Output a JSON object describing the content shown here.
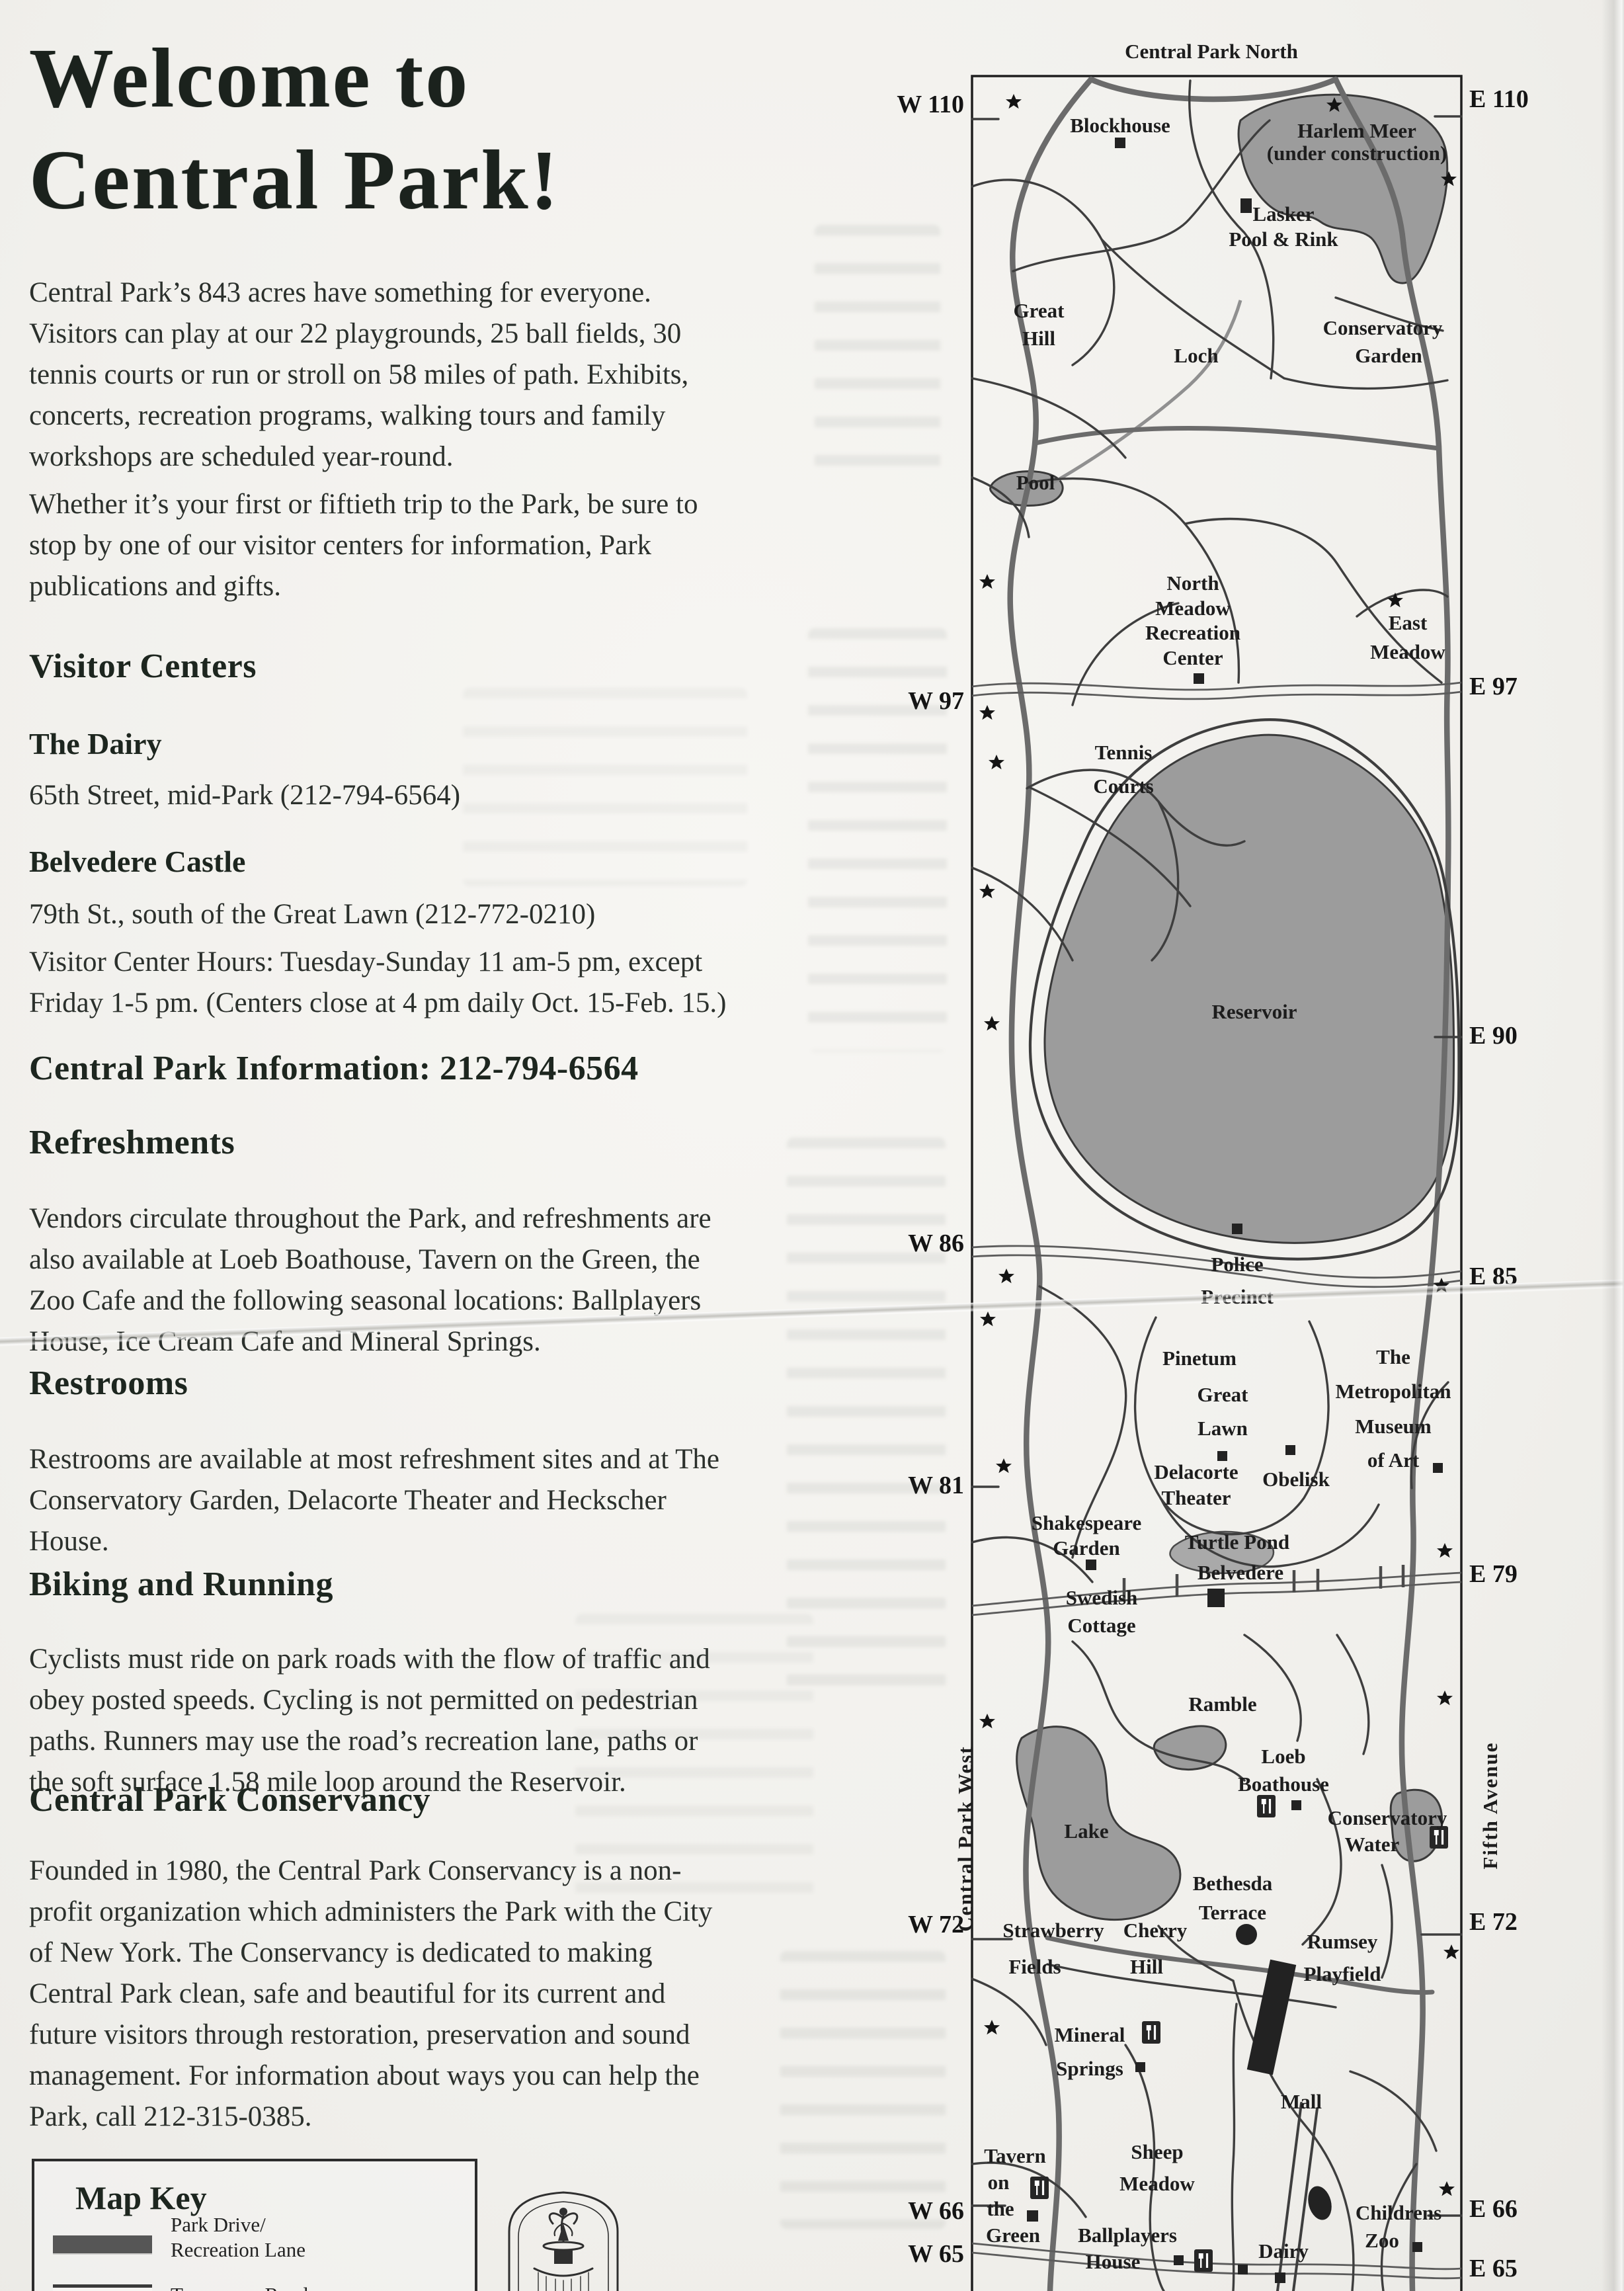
{
  "doc": {
    "title1": "Welcome to",
    "title2": "Central Park!",
    "p1": [
      "Central Park’s 843 acres have something for everyone.",
      "Visitors can play at our 22 playgrounds, 25 ball fields, 30",
      "tennis courts or run or stroll on 58 miles of path. Exhibits,",
      "concerts, recreation programs, walking tours and family",
      "workshops are scheduled year-round."
    ],
    "p2": [
      "Whether it’s your first or fiftieth trip to the Park, be sure to",
      "stop by one of our visitor centers for information, Park",
      "publications and gifts."
    ],
    "vc_heading": "Visitor Centers",
    "dairy_name": "The Dairy",
    "dairy_detail": "65th Street, mid-Park (212-794-6564)",
    "belvedere_name": "Belvedere Castle",
    "belvedere_detail": "79th St., south of the Great Lawn (212-772-0210)",
    "hours": [
      "Visitor Center Hours:  Tuesday-Sunday 11 am-5 pm, except",
      "Friday 1-5 pm. (Centers close at 4 pm daily Oct. 15-Feb. 15.)"
    ],
    "info_heading": "Central Park Information: 212-794-6564",
    "refreshments_heading": "Refreshments",
    "refreshments": [
      "Vendors circulate throughout the Park, and refreshments are",
      "also available at Loeb Boathouse, Tavern on the Green, the",
      "Zoo Cafe and the following seasonal locations: Ballplayers",
      "House, Ice Cream Cafe and Mineral Springs."
    ],
    "restrooms_heading": "Restrooms",
    "restrooms": [
      "Restrooms are available at most refreshment sites and at The",
      "Conservatory Garden, Delacorte Theater and Heckscher",
      "House."
    ],
    "biking_heading": "Biking and Running",
    "biking": [
      "Cyclists must ride on park roads with the flow of traffic and",
      "obey posted speeds. Cycling is not permitted on pedestrian",
      "paths. Runners may use the road’s recreation lane, paths or",
      "the soft surface 1.58 mile loop around the Reservoir."
    ],
    "conservancy_heading": "Central Park Conservancy",
    "conservancy": [
      "Founded in 1980, the Central Park Conservancy is a non-",
      "profit organization which administers the Park with the City",
      "of New York. The Conservancy is dedicated to making",
      "Central Park clean, safe and beautiful for its current and",
      "future visitors through restoration, preservation and sound",
      "management. For information about ways you can help the",
      "Park, call 212-315-0385."
    ],
    "map_key": {
      "heading": "Map Key",
      "item1_line1": "Park Drive/",
      "item1_line2": "Recreation Lane",
      "item2": "Transverse Road"
    }
  },
  "map": {
    "title": "Central Park North",
    "west_streets": {
      "w110": "W 110",
      "w97": "W 97",
      "w86": "W 86",
      "w81": "W 81",
      "w72": "W 72",
      "w66": "W 66",
      "w65": "W 65"
    },
    "east_streets": {
      "e110": "E 110",
      "e97": "E 97",
      "e90": "E 90",
      "e85": "E 85",
      "e79": "E 79",
      "e72": "E 72",
      "e66": "E 66",
      "e65": "E 65"
    },
    "avenues": {
      "west": "Central Park West",
      "east": "Fifth Avenue"
    },
    "labels": {
      "blockhouse": "Blockhouse",
      "harlem_meer": "Harlem Meer",
      "under_construction": "(under construction)",
      "lasker1": "Lasker",
      "lasker2": "Pool & Rink",
      "great_hill1": "Great",
      "great_hill2": "Hill",
      "loch": "Loch",
      "cons_garden1": "Conservatory",
      "cons_garden2": "Garden",
      "pool": "Pool",
      "north_meadow1": "North",
      "north_meadow2": "Meadow",
      "north_meadow3": "Recreation",
      "north_meadow4": "Center",
      "east_meadow1": "East",
      "east_meadow2": "Meadow",
      "tennis1": "Tennis",
      "tennis2": "Courts",
      "reservoir": "Reservoir",
      "police1": "Police",
      "police2": "Precinct",
      "pinetum": "Pinetum",
      "great_lawn1": "Great",
      "great_lawn2": "Lawn",
      "met1": "The",
      "met2": "Metropolitan",
      "met3": "Museum",
      "met4": "of Art",
      "delacorte1": "Delacorte",
      "delacorte2": "Theater",
      "obelisk": "Obelisk",
      "shakespeare1": "Shakespeare",
      "shakespeare2": "Garden",
      "turtle_pond": "Turtle Pond",
      "belvedere": "Belvedere",
      "swedish1": "Swedish",
      "swedish2": "Cottage",
      "ramble": "Ramble",
      "loeb1": "Loeb",
      "loeb2": "Boathouse",
      "cons_water1": "Conservatory",
      "cons_water2": "Water",
      "lake": "Lake",
      "bethesda1": "Bethesda",
      "bethesda2": "Terrace",
      "strawberry1": "Strawberry",
      "strawberry2": "Fields",
      "cherry1": "Cherry",
      "cherry2": "Hill",
      "rumsey1": "Rumsey",
      "rumsey2": "Playfield",
      "mineral1": "Mineral",
      "mineral2": "Springs",
      "mall": "Mall",
      "tavern1": "Tavern",
      "tavern2": "on",
      "tavern3": "the",
      "tavern4": "Green",
      "sheep1": "Sheep",
      "sheep2": "Meadow",
      "ballplayers1": "Ballplayers",
      "ballplayers2": "House",
      "dairy": "Dairy",
      "childrens1": "Childrens",
      "childrens2": "Zoo"
    }
  }
}
